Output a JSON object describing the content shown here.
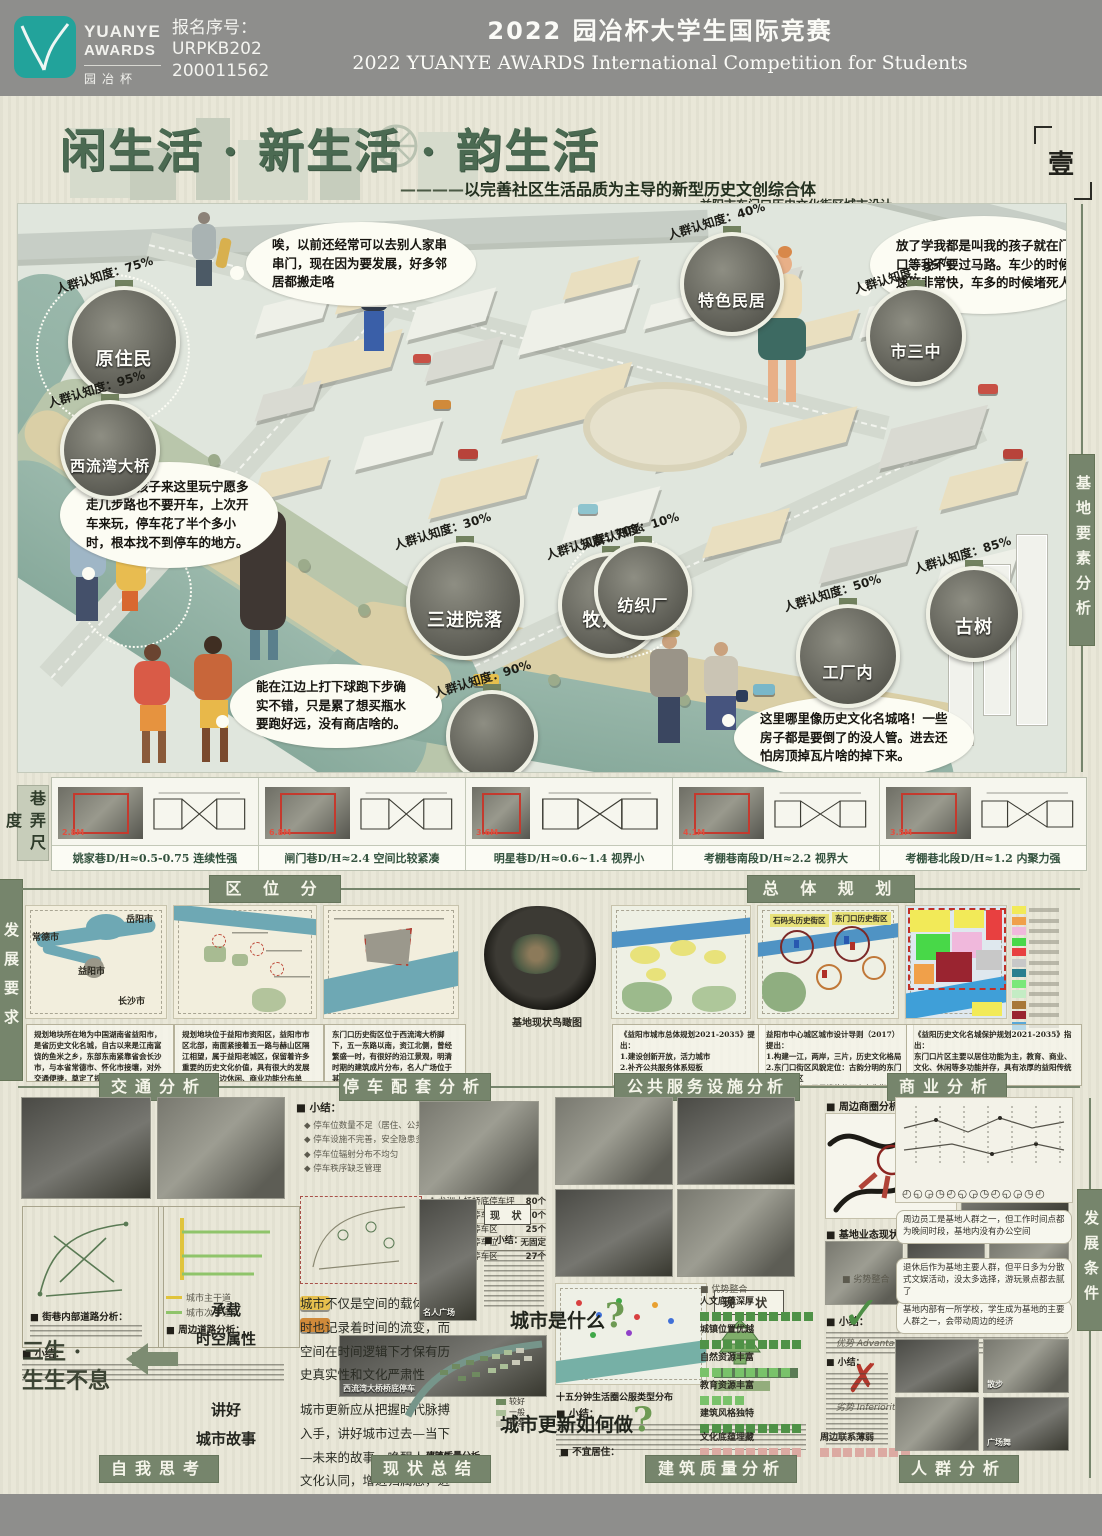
{
  "header": {
    "logo_line1": "YUANYE",
    "logo_line2": "AWARDS",
    "logo_cn": "园冶杯",
    "reg_text": "报名序号：\nURPKB202\n200011562",
    "title_cn": "2022 园冶杯大学生国际竞赛",
    "title_en": "2022 YUANYE AWARDS International Competition for  Students"
  },
  "title_block": {
    "main_title": "闲生活 · 新生活 · 韵生活",
    "subtitle_dash": "————",
    "subtitle": "以完善社区生活品质为主导的新型历史文创综合体",
    "location_line": "益阳市东门口历史文化街区城市设计",
    "page_marker": "壹"
  },
  "side_labels": {
    "right_top": "基地要素分析",
    "left_alley": "巷弄尺度",
    "left_mid": "发展要求",
    "right_bottom": "发展条件"
  },
  "scene": {
    "bubbles": [
      {
        "text": "唉，以前还经常可以去别人家串串门，现在因为要发展，好多邻居都搬走咯"
      },
      {
        "text": "放了学我都是叫我的孩子就在门口等我不要过马路。车少的时候速度非常快，车多的时候堵死人"
      },
      {
        "text": "现在来带孩子来这里玩宁愿多走几步路也不要开车，上次开车来玩，停车花了半个多小时，根本找不到停车的地方。"
      },
      {
        "text": "能在江边上打下球跑下步确实不错，只是累了想买瓶水要跑好远，没有商店啥的。"
      },
      {
        "text": "这里哪里像历史文化名城咯！一些房子都是要倒了的没人管。进去还怕房顶掉瓦片啥的掉下来。"
      }
    ],
    "callouts": [
      {
        "arc": "人群认知度：75%",
        "label": "原住民"
      },
      {
        "arc": "人群认知度：95%",
        "label": "西流湾大桥"
      },
      {
        "arc": "人群认知度：30%",
        "label": "三进院落"
      },
      {
        "arc": "人群认知度：70%",
        "label": "牧师楼"
      },
      {
        "arc": "人群认知度：40%",
        "label": "特色民居"
      },
      {
        "arc": "人群认知度：95%",
        "label": "市三中"
      },
      {
        "arc": "人群认知度：10%",
        "label": "纺织厂"
      },
      {
        "arc": "人群认知度：50%",
        "label": "工厂内"
      },
      {
        "arc": "人群认知度：85%",
        "label": "古树"
      },
      {
        "arc": "人群认知度：90%",
        "label": ""
      }
    ]
  },
  "alley": {
    "items": [
      {
        "caption": "姚家巷D/H≈0.5-0.75 连续性强",
        "dim": "2.8M"
      },
      {
        "caption": "闸门巷D/H≈2.4 空间比较紧凑",
        "dim": "6.8M"
      },
      {
        "caption": "明星巷D/H≈0.6~1.4 视界小",
        "dim": "3.6M"
      },
      {
        "caption": "考棚巷南段D/H≈2.2 视界大",
        "dim": "4.1M"
      },
      {
        "caption": "考棚巷北段D/H≈1.2 内聚力强",
        "dim": "3.5M"
      }
    ]
  },
  "sections": {
    "quwei": "区 位 分 析",
    "zongti": "总 体 规 划",
    "jiaotong": "交通分析",
    "tingche": "停车配套分析",
    "gongfu": "公共服务设施分析",
    "shangye": "商业分析",
    "ziwo": "自我思考",
    "xianzhuang": "现状总结",
    "jianzhu": "建筑质量分析",
    "renqun": "人群分析"
  },
  "quwei": {
    "city_labels": [
      "常德市",
      "岳阳市",
      "益阳市",
      "长沙市"
    ],
    "texts": [
      "规划地块所在地为中国湖南省益阳市，是省历史文化名城，自古以来是江南富饶的鱼米之乡，东部东南紧靠省会长沙市，与本省常德市、怀化市接壤，对外交通便捷，奠定了规划地块对外服务的基础。",
      "规划地块位于益阳市资阳区，益阳市市区北部，南面紧接着五一路与赫山区隔江相望，属于益阳老城区，保留着许多重要的历史文化价值，具有很大的发展潜力，但周边休闲、商业功能分布单一，为地块转型发展提供了依据。",
      "东门口历史街区位于西流湾大桥脚下，五一东路以南，资江北侧，曾经繁盛一时，有很好的沿江景观，明清时期的建筑成片分布，名人广场位于其中，古树、古宅、历史名人等，为地块发展打下了深厚的历史文化基础。"
    ],
    "aerial_caption": "基地现状鸟瞰图"
  },
  "zongti": {
    "district_labels": [
      "石码头历史街区",
      "东门口历史街区"
    ],
    "texts": [
      "《益阳市城市总体规划2021-2035》提出：\n1.建设创新开放，活力城市\n2.补齐公共服务体系短板\n3.构建益阳历史文化遗产整体保护体系",
      "益阳市中心城区城市设计导则（2017）提出：\n1.构建一江，两岸，三片，历史文化格局\n2.东门口街区风貌定位：古韵分明的东门口历史街区\n3.大气恢弘、民风淳朴的历史文化街区，已展现益阳古城和民俗遗风为主",
      "《益阳历史文化名城保护规划2021-2035》指出：\n东门口片区主要以居住功能为主，教育、商业、文化、休闲等多功能并存，具有浓厚的益阳传统建筑文化特色和典型"
    ]
  },
  "jiaotong": {
    "label1": "■ 街巷内部道路分析：",
    "label2": "■ 周边道路分析：",
    "legend1": "城市主干道",
    "legend2": "城市次干道",
    "summary_label": "■ 小结："
  },
  "tingche": {
    "summary_label": "■ 小结：",
    "bullets": [
      "◆ 停车位数量不足（居住、公共等）",
      "◆ 停车设施不完善，安全隐患多",
      "◆ 停车位辐射分布不均匀",
      "◆ 停车秩序缺乏管理"
    ],
    "table": [
      {
        "name": "1.龙洲大桥桥底停车坪",
        "count": "80个"
      },
      {
        "name": "2.厂区内部停车区",
        "count": "≈50个"
      },
      {
        "name": "3.沿街区域停车区",
        "count": "25个"
      },
      {
        "name": "4.消防通道停车位",
        "count": "无固定"
      },
      {
        "name": "5.学校西侧停车区",
        "count": "27个"
      }
    ],
    "photo_caption": "西流湾大桥桥底停车"
  },
  "gongfu": {
    "caption": "十五分钟生活圈公服类型分布",
    "status_label": "现  状",
    "summary_label": "■ 小结："
  },
  "shangye": {
    "label1": "■ 周边商圈分析：",
    "label2": "■ 基地业态现状分析：",
    "summary_label": "■ 小结：",
    "mall_caption": "万达广场"
  },
  "ziwo": {
    "slogan": "三生 ·\n生生不息",
    "kw1a": "承载",
    "kw1b": "时空属性",
    "kw2a": "讲好",
    "kw2b": "城市故事",
    "para1": "城市不仅是空间的载体，同时也记录着时间的流变，而空间在时间逻辑下才保有历史真实性和文化严肃性",
    "para2": "城市更新应从把握时代脉搏入手，讲好城市过去—当下—未来的故事，唤醒人们的文化认同，增进归属感，进而营造美好共同家园。",
    "q1": "城市是什么",
    "q2": "城市更新如何做",
    "qmark": "?",
    "adv_label": "■ 优势整合",
    "dis_label": "■ 劣势整合",
    "adv_word": "优势  Advantage",
    "dis_word": "劣势  Inferiority",
    "check": "✓",
    "cross": "✗",
    "pos_bars": [
      {
        "label": "人文底蕴深厚",
        "n": 10
      },
      {
        "label": "城镇位置优越",
        "n": 9
      },
      {
        "label": "自然资源丰富",
        "n": 8
      },
      {
        "label": "教育资源丰富",
        "n": 4
      },
      {
        "label": "建筑风格独特",
        "n": 9
      }
    ],
    "neg_bars": [
      {
        "label": "文化底蕴埋藏",
        "n": 9
      },
      {
        "label": "周边联系薄弱",
        "n": 8
      }
    ]
  },
  "xianzhuang": {
    "status_label": "现  状",
    "summary_label": "■ 小结：",
    "photo_label": "名人广场"
  },
  "jianzhu": {
    "legend_title": "图例",
    "legend": [
      "较好",
      "一般",
      "较差"
    ],
    "label1": "■ 不宜居住：",
    "label2": "■ 可改造修缮：",
    "map_caption": "建筑质量分析"
  },
  "renqun": {
    "clocks": "◴◵◶◷◴◵◶◷◴◵◶◷◴",
    "bubbles": [
      "基地内部有一所学校，学生成为基地的主要人群之一，会带动周边的经济",
      "周边员工是基地人群之一，但工作时间点都为晚间时段，基地内没有办公空间",
      "退休后作为基地主要人群，但平日多为分散式文娱活动，没太多选择，游玩景点都去腻了"
    ],
    "photo_labels": [
      "散步",
      "广场舞"
    ],
    "summary_label": "■ 小结："
  }
}
